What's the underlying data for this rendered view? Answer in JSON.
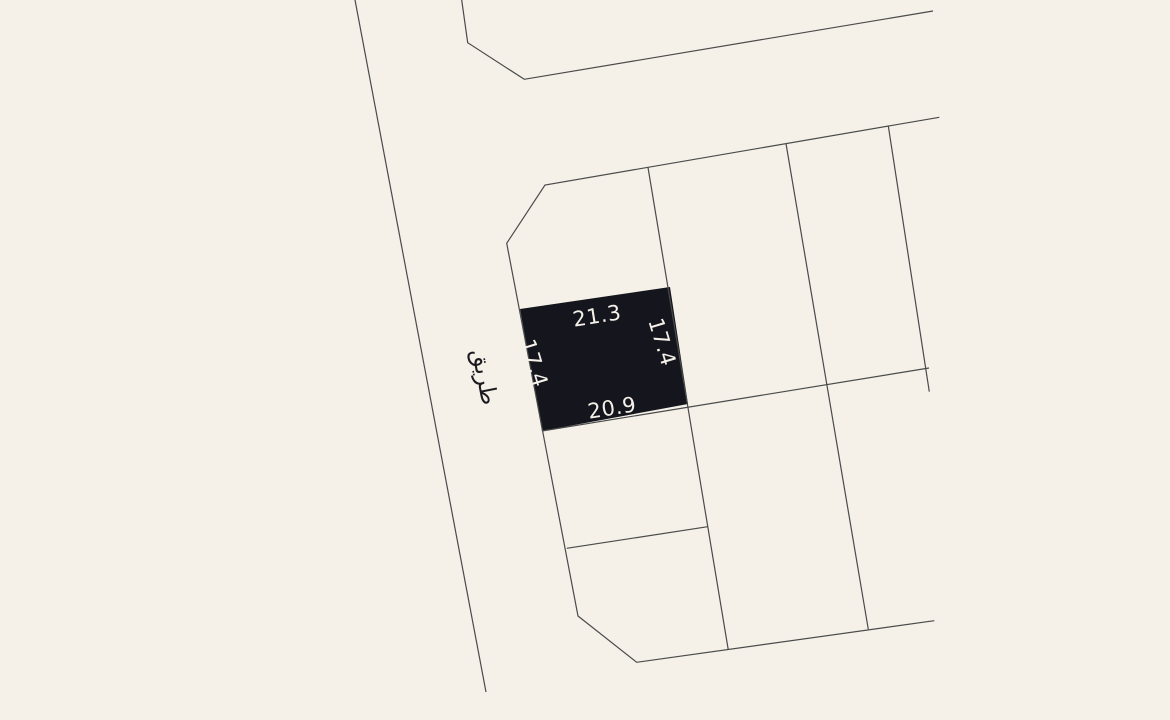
{
  "map": {
    "background_color": "#f5f1e9",
    "boundary_line_color": "#4a4a4a",
    "road_label": "طريق",
    "highlighted_parcel": {
      "fill_color": "#15161d",
      "label_color": "#f5f1e9",
      "dimensions": {
        "top": "21.3",
        "right": "17.4",
        "bottom": "20.9",
        "left": "17.4"
      }
    }
  }
}
